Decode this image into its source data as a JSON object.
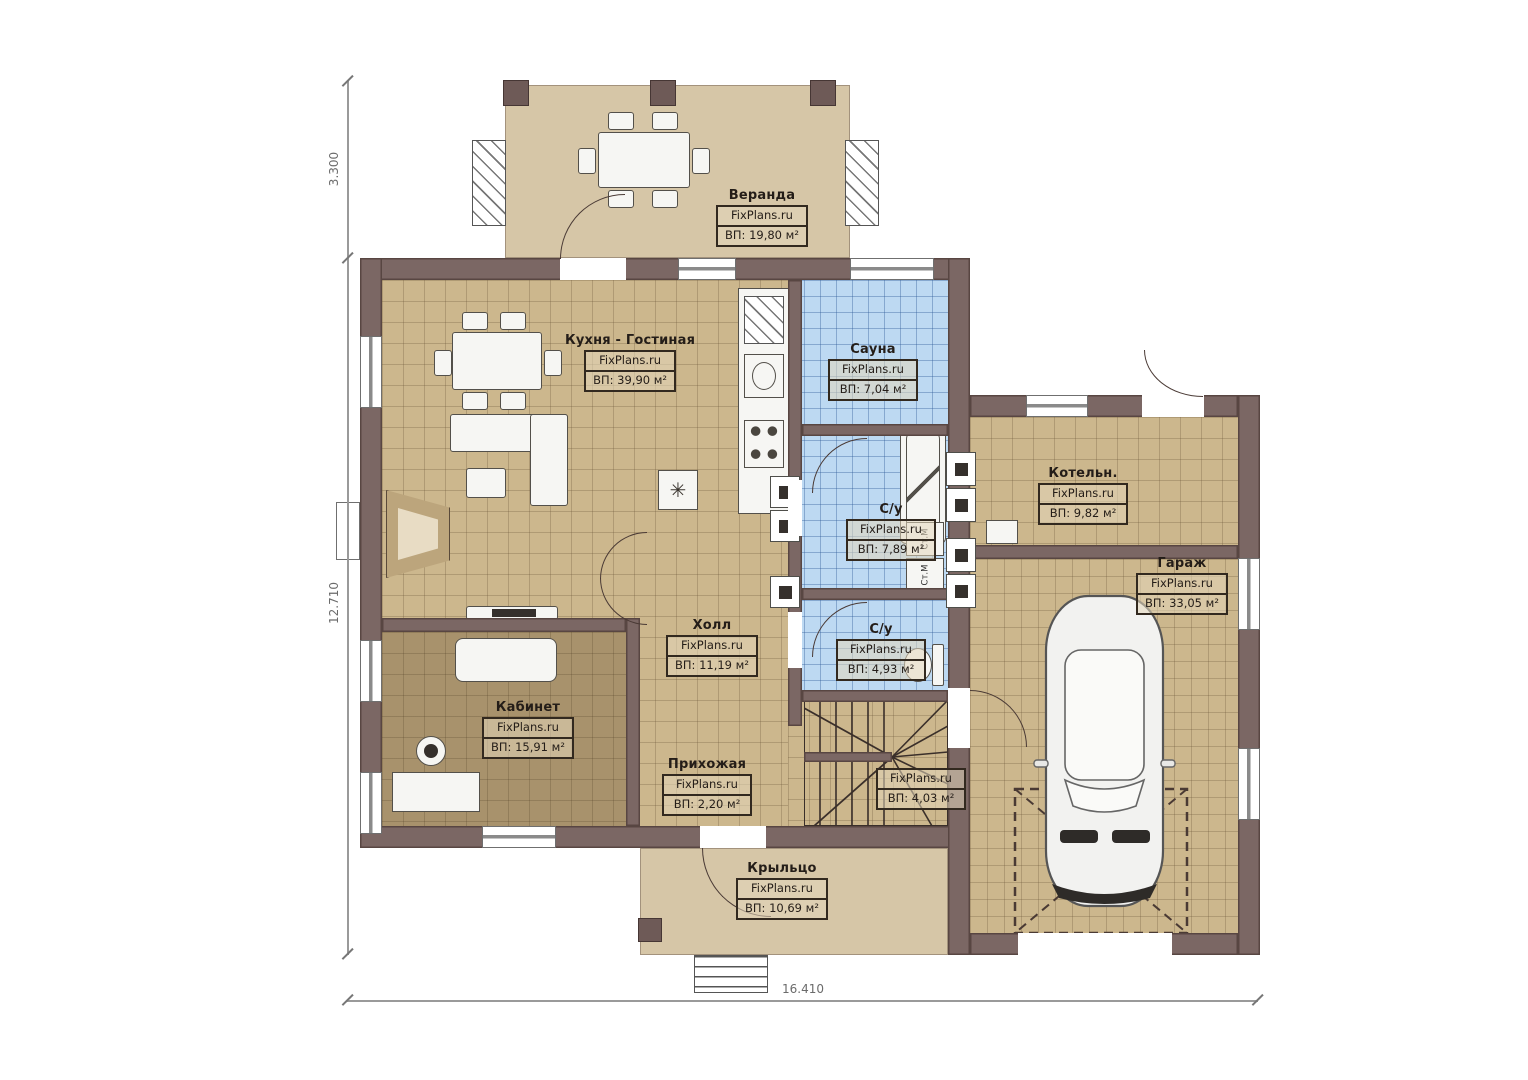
{
  "plan": {
    "watermark": "FixPlans.ru",
    "rooms": [
      {
        "name": "Веранда",
        "area": "ВП: 19,80 м²"
      },
      {
        "name": "Кухня - Гостиная",
        "area": "ВП: 39,90 м²"
      },
      {
        "name": "Сауна",
        "area": "ВП: 7,04 м²"
      },
      {
        "name": "С/у",
        "area": "ВП: 7,89 м²"
      },
      {
        "name": "Котельн.",
        "area": "ВП: 9,82 м²"
      },
      {
        "name": "Гараж",
        "area": "ВП: 33,05 м²"
      },
      {
        "name": "Холл",
        "area": "ВП: 11,19 м²"
      },
      {
        "name": "С/у",
        "area": "ВП: 4,93 м²"
      },
      {
        "name": "Кабинет",
        "area": "ВП: 15,91 м²"
      },
      {
        "name": "Прихожая",
        "area": "ВП: 2,20 м²"
      },
      {
        "name": "",
        "area": "ВП: 4,03 м²"
      },
      {
        "name": "Крыльцо",
        "area": "ВП: 10,69 м²"
      }
    ],
    "annotations": {
      "washing_machine": "Ст.М",
      "vent_symbol": "✳"
    },
    "dimensions": {
      "veranda_depth": "3.300",
      "house_depth": "12.710",
      "total_width": "16.410"
    },
    "colors": {
      "wall": "#7b6764",
      "floor_tan": "#ccb78d",
      "floor_wet": "#bdd9f2",
      "floor_office": "#a8926c",
      "floor_veranda": "#d6c6a7"
    }
  }
}
